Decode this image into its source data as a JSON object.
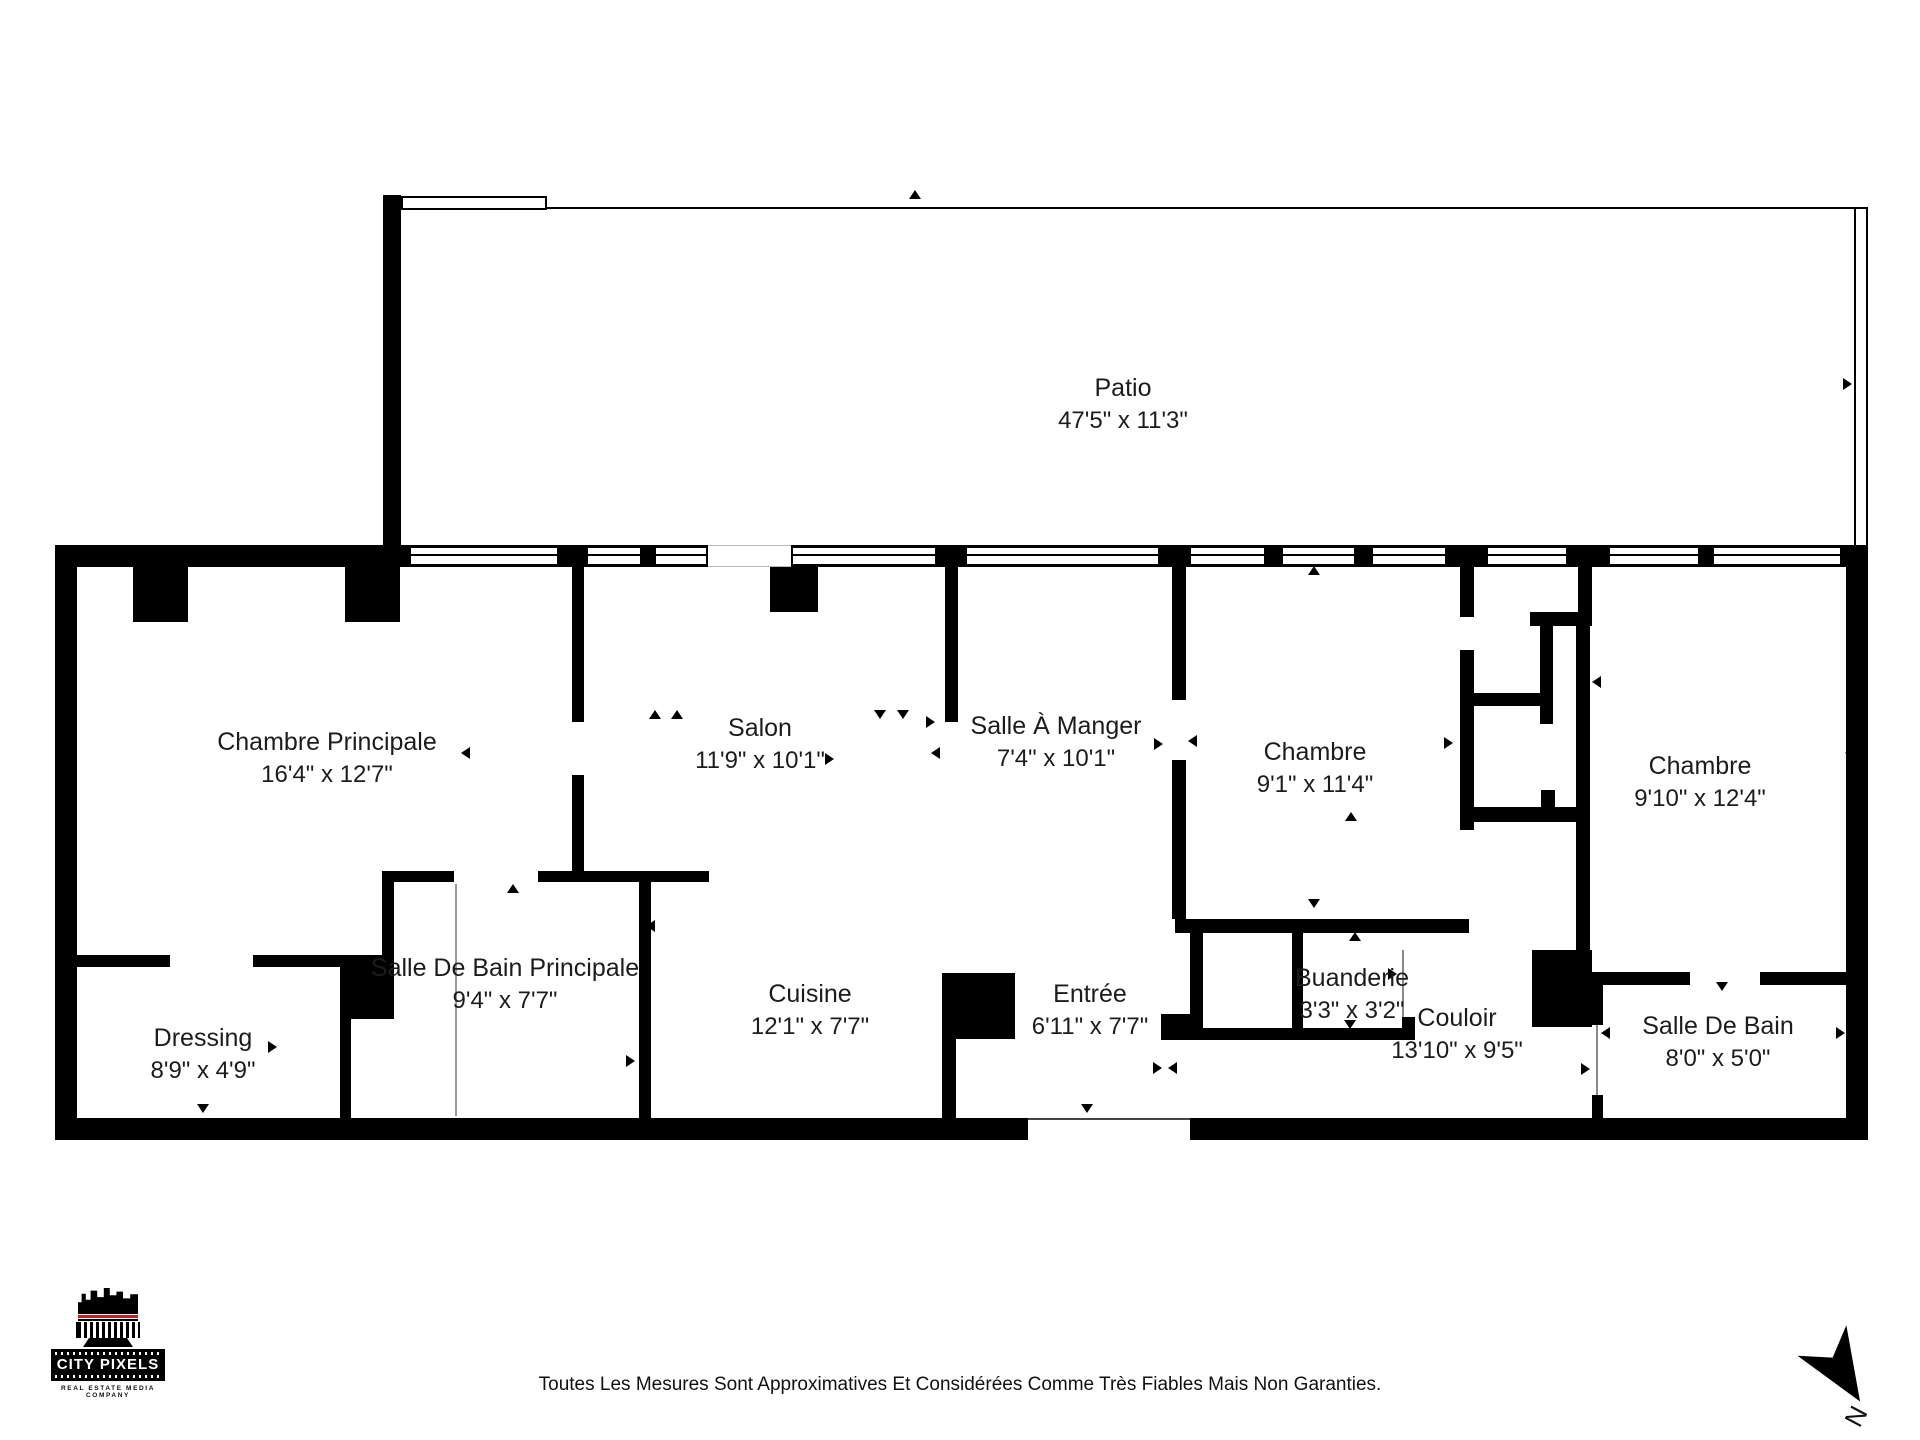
{
  "rooms": [
    {
      "id": "patio",
      "name": "Patio",
      "dims": "47'5\" x 11'3\""
    },
    {
      "id": "chambre-principale",
      "name": "Chambre Principale",
      "dims": "16'4\" x 12'7\""
    },
    {
      "id": "salon",
      "name": "Salon",
      "dims": "11'9\" x 10'1\""
    },
    {
      "id": "salle-a-manger",
      "name": "Salle À Manger",
      "dims": "7'4\" x 10'1\""
    },
    {
      "id": "chambre-2",
      "name": "Chambre",
      "dims": "9'1\" x 11'4\""
    },
    {
      "id": "chambre-3",
      "name": "Chambre",
      "dims": "9'10\" x 12'4\""
    },
    {
      "id": "dressing",
      "name": "Dressing",
      "dims": "8'9\" x 4'9\""
    },
    {
      "id": "salle-de-bain-principale",
      "name": "Salle De Bain Principale",
      "dims": "9'4\" x 7'7\""
    },
    {
      "id": "cuisine",
      "name": "Cuisine",
      "dims": "12'1\" x 7'7\""
    },
    {
      "id": "entree",
      "name": "Entrée",
      "dims": "6'11\" x 7'7\""
    },
    {
      "id": "buanderie",
      "name": "Buanderie",
      "dims": "3'3\" x 3'2\""
    },
    {
      "id": "couloir",
      "name": "Couloir",
      "dims": "13'10\" x 9'5\""
    },
    {
      "id": "salle-de-bain",
      "name": "Salle De Bain",
      "dims": "8'0\" x 5'0\""
    }
  ],
  "logo": {
    "name": "CITY PIXELS",
    "tagline": "REAL ESTATE MEDIA COMPANY",
    "accent_color": "#c0222b"
  },
  "compass": {
    "north_label": "N"
  },
  "footer": {
    "disclaimer": "Toutes Les Mesures Sont Approximatives Et Considérées Comme Très Fiables Mais Non Garanties."
  }
}
